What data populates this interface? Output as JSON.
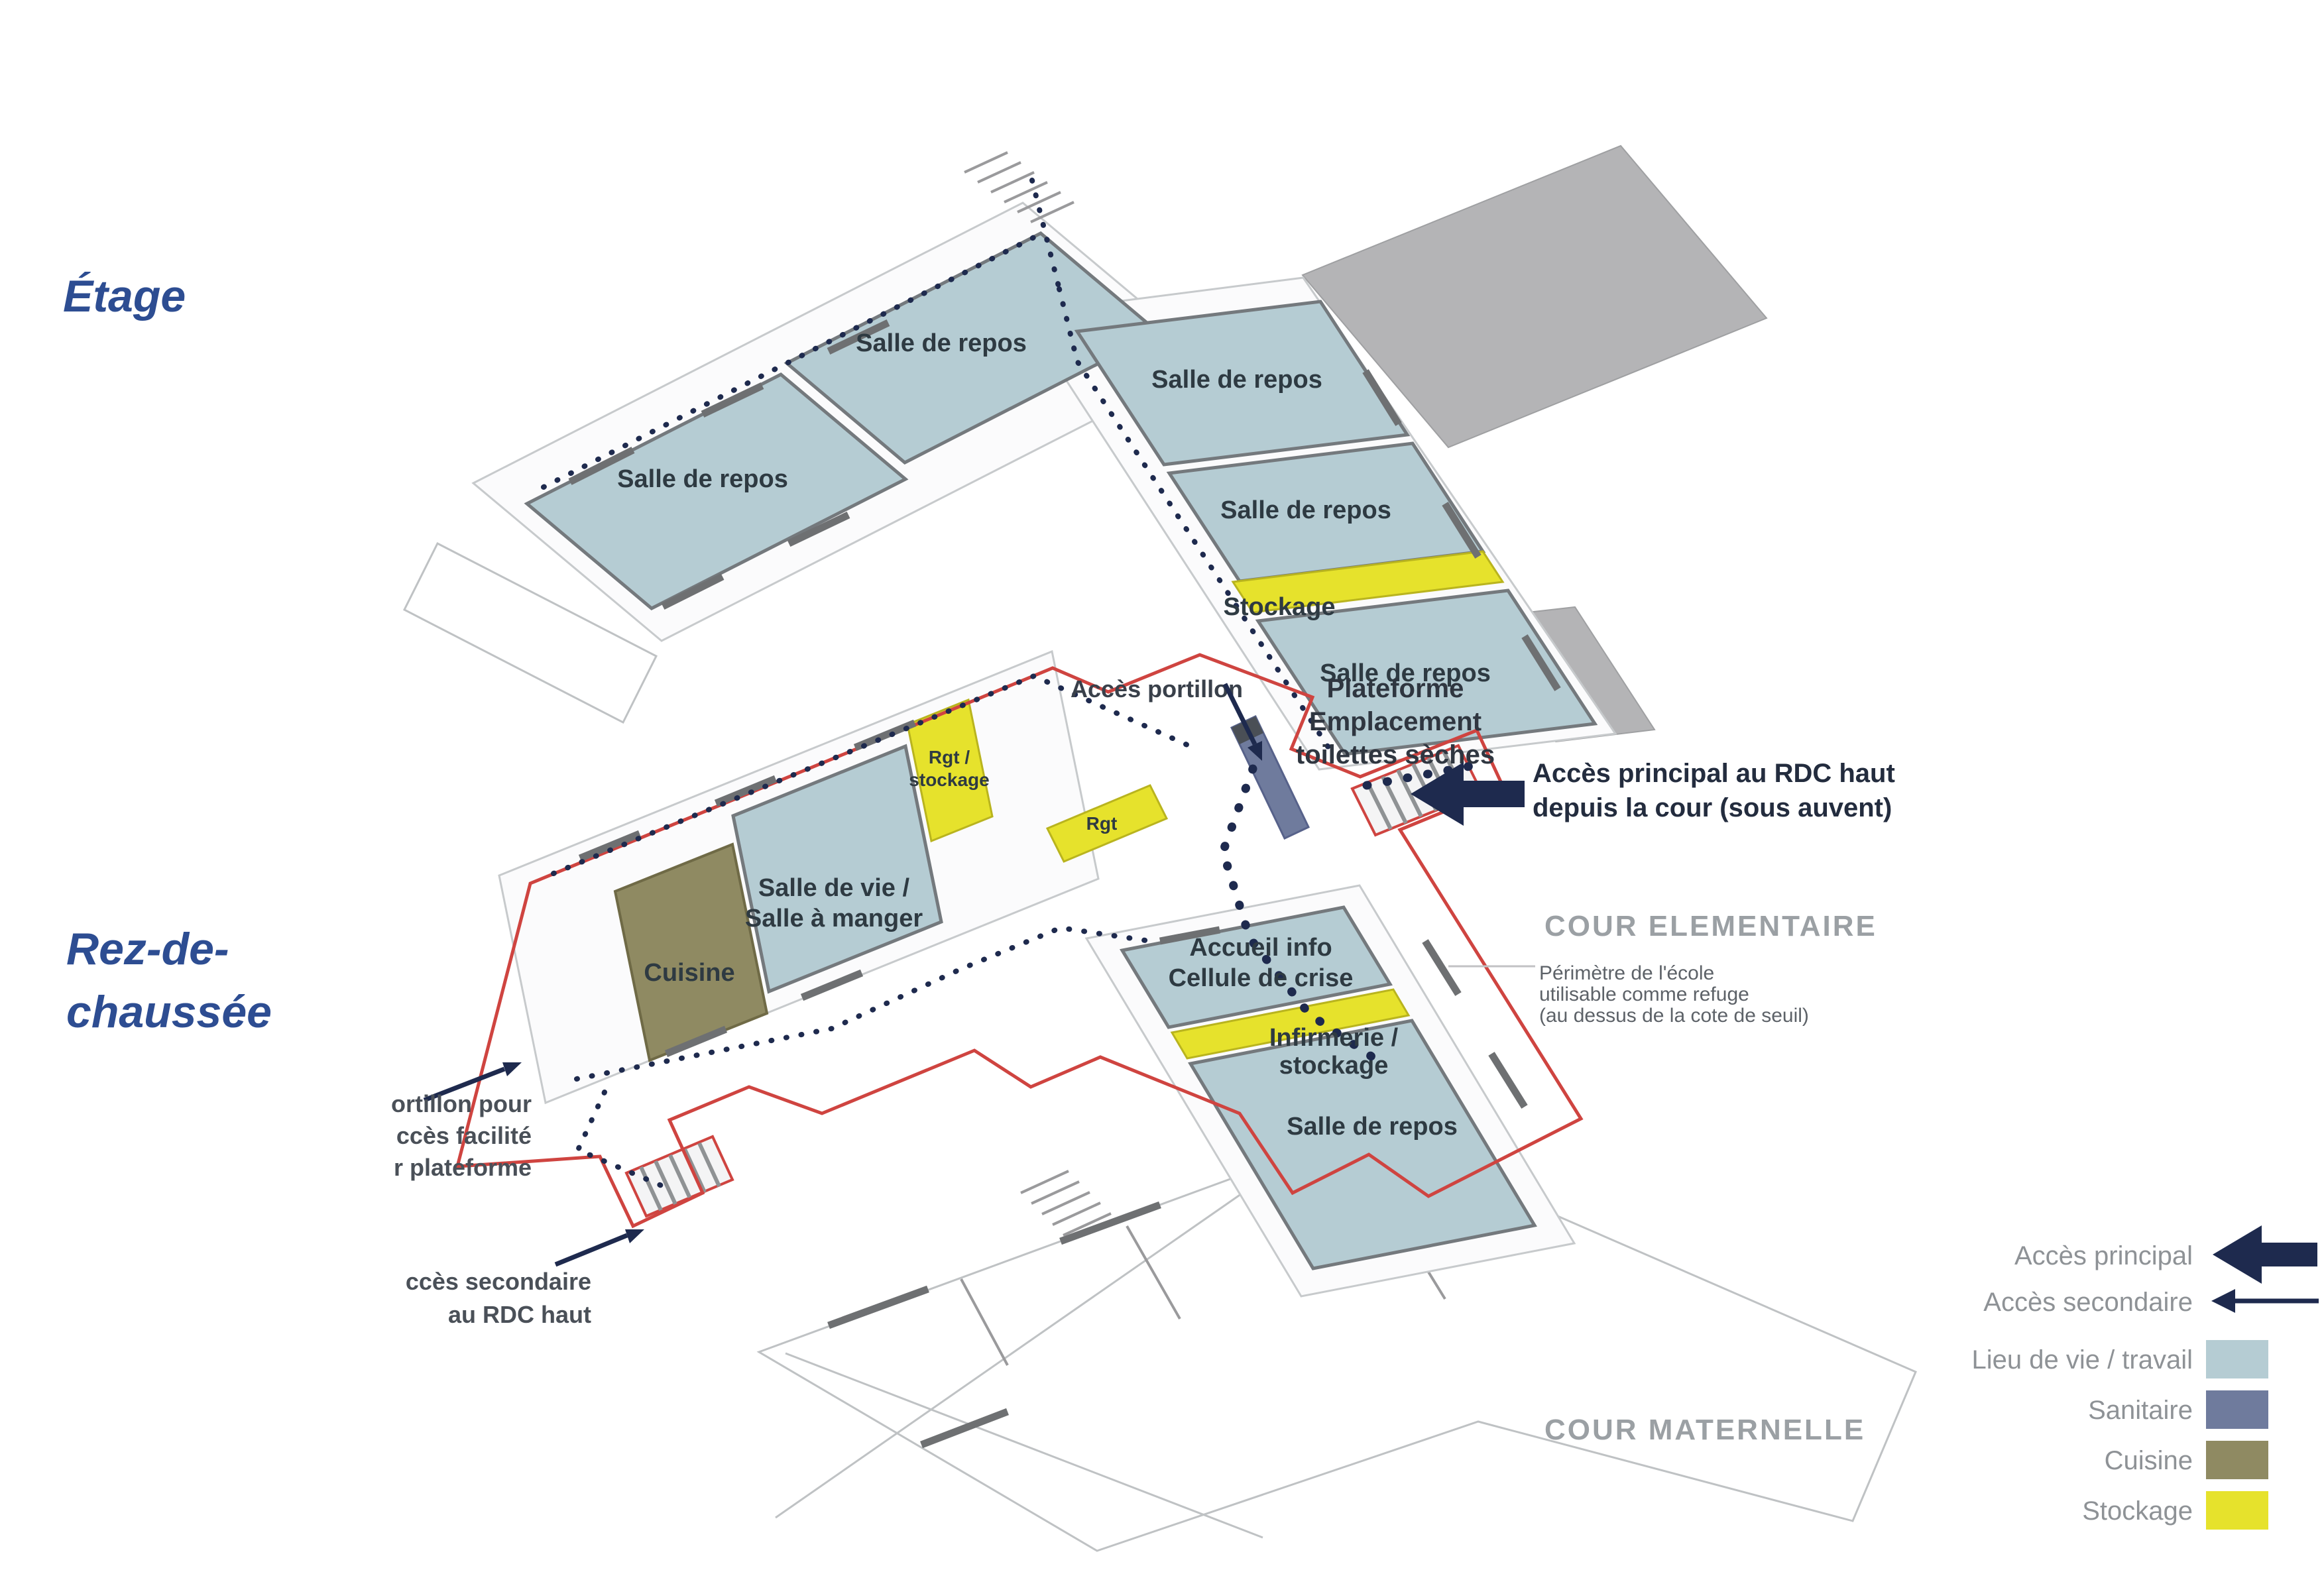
{
  "colors": {
    "title_blue": "#2d4d92",
    "room_blue": "#b5ccd3",
    "stockage_yellow": "#e6e22c",
    "cuisine_olive": "#8f8a62",
    "sanitaire_blue": "#6f7b9d",
    "roof_gray": "#b4b4b6",
    "navy": "#1e2a4e",
    "red_perimeter": "#cf4440",
    "label_dark": "#2e3a42",
    "gray_label": "#9ba0a4"
  },
  "titles": {
    "upper": "Étage",
    "lower_line1": "Rez-de-",
    "lower_line2": "chaussée"
  },
  "upper_floor": {
    "room_a": "Salle de repos",
    "room_b": "Salle de repos",
    "room_c": "Salle de repos",
    "room_d": "Salle de repos",
    "stockage": "Stockage",
    "room_e": "Salle de repos"
  },
  "ground_floor": {
    "salle_de_vie": {
      "lines": [
        "Salle de vie /",
        "Salle à manger"
      ]
    },
    "cuisine": "Cuisine",
    "rgt_stockage": {
      "lines": [
        "Rgt /",
        "stockage"
      ]
    },
    "rgt": "Rgt",
    "accueil": {
      "lines": [
        "Accueil info",
        "Cellule de crise"
      ]
    },
    "infirmerie": {
      "lines": [
        "Infirmerie /",
        "stockage"
      ]
    },
    "salle_de_repos": "Salle de repos"
  },
  "annotations": {
    "acces_portillon": "Accès portillon",
    "plateforme": {
      "lines": [
        "Plateforme",
        "Emplacement",
        "toilettes sèches"
      ]
    },
    "acces_principal": {
      "lines": [
        "Accès principal au RDC haut",
        "depuis la cour (sous auvent)"
      ]
    },
    "perimetre": {
      "lines": [
        "Périmètre de l'école",
        "utilisable comme refuge",
        "(au dessus de la cote de seuil)"
      ]
    },
    "portillon_note": {
      "lines": [
        "ortillon pour",
        "ccès facilité",
        "r plateforme"
      ]
    },
    "acces_secondaire_note": {
      "lines": [
        "ccès secondaire",
        "au RDC haut"
      ]
    },
    "cour_elementaire": "COUR ELEMENTAIRE",
    "cour_maternelle": "COUR MATERNELLE"
  },
  "legend": {
    "acces_principal": "Accès principal",
    "acces_secondaire": "Accès secondaire",
    "lieu_de_vie": "Lieu de vie / travail",
    "sanitaire": "Sanitaire",
    "cuisine": "Cuisine",
    "stockage": "Stockage"
  }
}
